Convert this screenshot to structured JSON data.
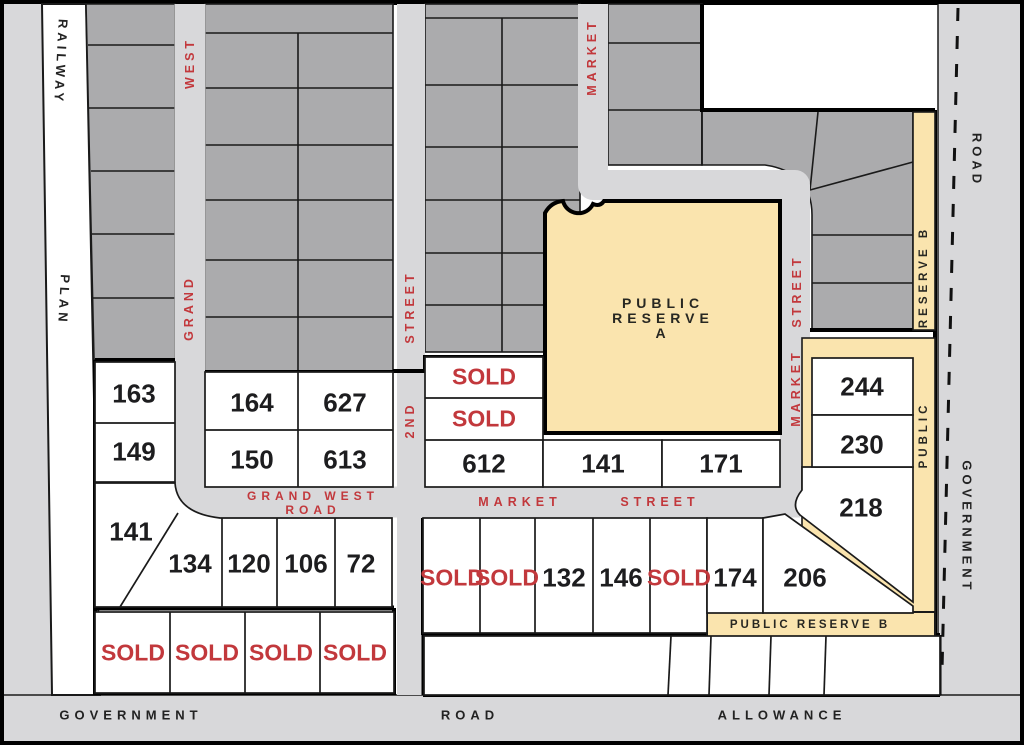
{
  "colors": {
    "lot_gray": "#ababad",
    "street_gray": "#d8d8da",
    "reserve_yellow": "#fae4ae",
    "red": "#c2383c",
    "outline": "#1a1a1a",
    "white_lot": "#ffffff"
  },
  "roads": {
    "railway": "RAILWAY",
    "plan": "PLAN",
    "road_top_right": "ROAD",
    "government_right": "GOVERNMENT",
    "government_bottom": "GOVERNMENT",
    "road_bottom": "ROAD",
    "allowance_bottom": "ALLOWANCE"
  },
  "streets": {
    "west": "WEST",
    "grand": "GRAND",
    "street_2nd_upper": "STREET",
    "second": "2ND",
    "market_top": "MARKET",
    "street_right": "STREET",
    "market_right": "MARKET",
    "grand_west_line1": "GRAND WEST",
    "grand_west_line2": "ROAD",
    "market_h": "MARKET",
    "street_h": "STREET"
  },
  "reserves": {
    "a_line1": "PUBLIC",
    "a_line2": "RESERVE",
    "a_line3": "A",
    "b_vertical": "RESERVE B",
    "public_vertical": "PUBLIC",
    "b_bottom": "PUBLIC RESERVE B"
  },
  "lots": [
    {
      "label": "163"
    },
    {
      "label": "149"
    },
    {
      "label": "164"
    },
    {
      "label": "627"
    },
    {
      "label": "150"
    },
    {
      "label": "613"
    },
    {
      "label": "SOLD"
    },
    {
      "label": "SOLD"
    },
    {
      "label": "612"
    },
    {
      "label": "141"
    },
    {
      "label": "171"
    },
    {
      "label": "141"
    },
    {
      "label": "134"
    },
    {
      "label": "120"
    },
    {
      "label": "106"
    },
    {
      "label": "72"
    },
    {
      "label": "SOLD"
    },
    {
      "label": "SOLD"
    },
    {
      "label": "132"
    },
    {
      "label": "146"
    },
    {
      "label": "SOLD"
    },
    {
      "label": "174"
    },
    {
      "label": "206"
    },
    {
      "label": "244"
    },
    {
      "label": "230"
    },
    {
      "label": "218"
    },
    {
      "label": "SOLD"
    },
    {
      "label": "SOLD"
    },
    {
      "label": "SOLD"
    },
    {
      "label": "SOLD"
    }
  ]
}
